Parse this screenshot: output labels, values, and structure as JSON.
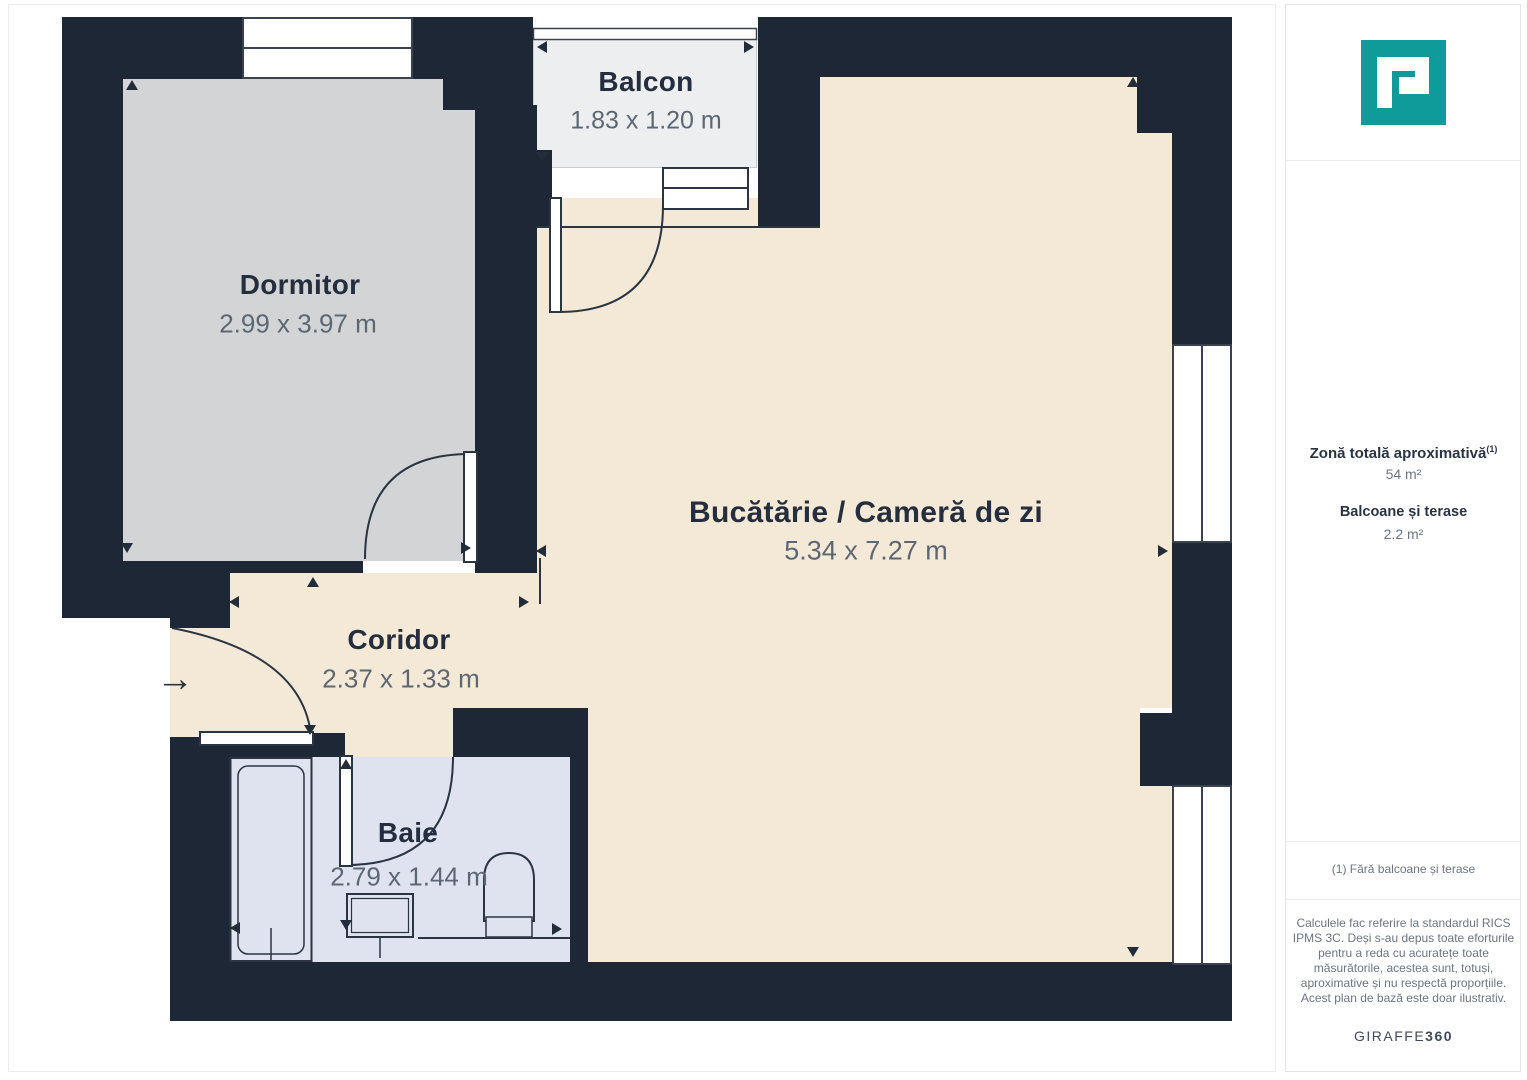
{
  "plan": {
    "rooms": [
      {
        "name": "Dormitor",
        "dims": "2.99 x 3.97 m"
      },
      {
        "name": "Balcon",
        "dims": "1.83 x 1.20 m"
      },
      {
        "name": "Bucătărie / Cameră de zi",
        "dims": "5.34 x 7.27 m"
      },
      {
        "name": "Coridor",
        "dims": "2.37 x 1.33 m"
      },
      {
        "name": "Baie",
        "dims": "2.79 x 1.44 m"
      }
    ],
    "entry_arrow": "→",
    "colors": {
      "wall": "#1d2735",
      "floor_main": "#f3e9d6",
      "floor_bedroom": "#d3d4d6",
      "floor_balcony": "#eceef0",
      "floor_bathroom": "#dee3ef",
      "brand_teal": "#109b9b"
    }
  },
  "sidebar": {
    "total_area_label": "Zonă totală aproximativă",
    "total_area_note_ref": "(1)",
    "total_area_value": "54 m²",
    "balcony_label": "Balcoane și terase",
    "balcony_value": "2.2 m²",
    "footnote": "(1) Fără balcoane și terase",
    "disclaimer": "Calculele fac referire la standardul RICS IPMS 3C. Deși s-au depus toate eforturile pentru a reda cu acuratețe toate măsurătorile, acestea sunt, totuși, aproximative și nu respectă proporțiile. Acest plan de bază este doar ilustrativ.",
    "brand_name": "GIRAFFE",
    "brand_suffix": "360"
  }
}
